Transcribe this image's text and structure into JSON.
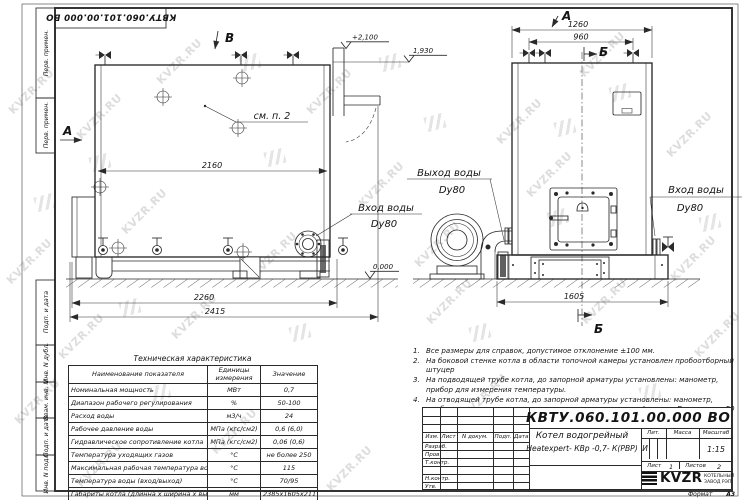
{
  "watermark": {
    "text": "KVZR.RU"
  },
  "stamp": {
    "doc_number": "КВТУ.060.101.00.000  ВО"
  },
  "margin": {
    "labels": [
      "Перв. примен.",
      "Перв. примен.",
      "Подп. и дата",
      "Инв. N дубл.",
      "Взам. инв. N",
      "Подп. и дата",
      "Инв. N подл."
    ]
  },
  "views": {
    "left": {
      "view_label": "В",
      "section_label": "А",
      "see_note": "см. п. 2",
      "dim_depth": "2160",
      "dim_base": "2260",
      "dim_overall": "2415",
      "elev_top": "+2,100",
      "elev_shell": "1,930",
      "elev_zero": "0,000",
      "inlet_line1": "Вход воды",
      "inlet_line2": "Dy80"
    },
    "right": {
      "view_label": "А",
      "section_label": "Б",
      "dim_width": "1260",
      "dim_vents": "960",
      "dim_base": "1605",
      "outlet_line1": "Выход воды",
      "outlet_line2": "Dy80",
      "inlet_line1": "Вход воды",
      "inlet_line2": "Dy80"
    }
  },
  "tech": {
    "title": "Техническая характеристика",
    "headers": [
      "Наименование показателя",
      "Единицы измерения",
      "Значение"
    ],
    "rows": [
      [
        "Номинальная мощность",
        "МВт",
        "0,7"
      ],
      [
        "Диапазон рабочего регулирования",
        "%",
        "50-100"
      ],
      [
        "Расход воды",
        "м3/ч",
        "24"
      ],
      [
        "Рабочее давление воды",
        "МПа (кгс/см2)",
        "0,6 (6,0)"
      ],
      [
        "Гидравлическое сопротивление котла",
        "МПа (кгс/см2)",
        "0,06 (0,6)"
      ],
      [
        "Температура уходящих газов",
        "°С",
        "не более 250"
      ],
      [
        "Максимальная рабочая температура воды",
        "°С",
        "115"
      ],
      [
        "Температура воды (вход/выход)",
        "°С",
        "70/95"
      ],
      [
        "Габариты котла (длинна х ширина х высота)",
        "мм",
        "2385х1605х2117"
      ]
    ]
  },
  "notes": [
    {
      "n": "1.",
      "text": "Все размеры для справок, допустимое отклонение ±100 мм."
    },
    {
      "n": "2.",
      "text": "На боковой стенке котла в области топочной камеры установлен пробоотборный штуцер"
    },
    {
      "n": "3.",
      "text": "На подводящей трубе котла, до запорной арматуры установлены: манометр, прибор для измерения температуры."
    },
    {
      "n": "4.",
      "text": "На отводящей трубе котла, до запорной арматуры установлены: манометр, прибор для измерения температуры, предохранительный клапан Dу не менее 50 мм и отвод с обратным клапаном Dу не менее 50 мм."
    }
  ],
  "title_block": {
    "doc_number": "КВТУ.060.101.00.000  ВО",
    "name_line1": "Котел водогрейный",
    "name_line2": "Heatexpert- КВр -0,7- К(РВР)",
    "cols": [
      "Изм.",
      "Лист",
      "N докум.",
      "Подп.",
      "Дата"
    ],
    "rows": [
      "Разраб.",
      "Пров.",
      "Т.контр.",
      "Н.контр.",
      "Утв."
    ],
    "lit_label": "Лит.",
    "lit_value": "И",
    "mass_label": "Масса",
    "scale_label": "Масштаб",
    "scale_value": "1:15",
    "sheet_label": "Лист",
    "sheet_value": "1",
    "sheets_label": "Листов",
    "sheets_value": "2",
    "logo_text": "KVZR",
    "company_line1": "КОТЕЛЬНЫЙ",
    "company_line2": "ЗАВОД РЭП",
    "format_label": "Формат",
    "format_value": "А3"
  }
}
